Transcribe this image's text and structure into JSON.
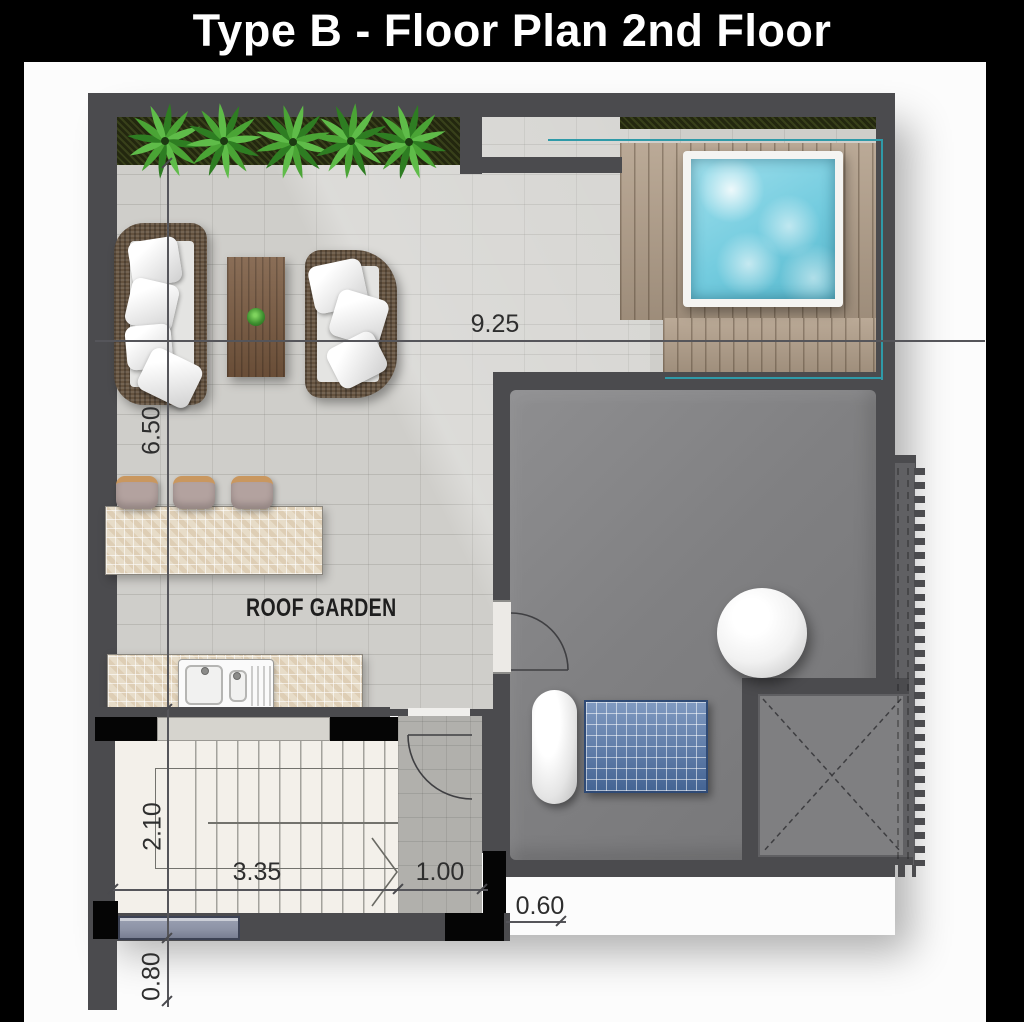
{
  "title": "Type B - Floor Plan 2nd Floor",
  "plan": {
    "room_label": "ROOF GARDEN",
    "dimensions": {
      "terrace_width_m": "9.25",
      "terrace_depth_m": "6.50",
      "stair_depth_m": "2.10",
      "stair_width_m": "3.35",
      "landing_width_m": "1.00",
      "right_offset_m": "0.60",
      "bottom_offset_m": "0.80"
    }
  },
  "colors": {
    "title_bg": "#000000",
    "title_text": "#ffffff",
    "wall": "#4b4b4e",
    "floor_tile": "#cfceca",
    "room_floor": "#808082",
    "deck": "#b3a08b",
    "pool_water": "#74ccdf",
    "glass_rail": "#2f9aa8",
    "planter_soil": "#23270f",
    "plant_green": "#3f9130",
    "counter_mosaic": "#e7dcc8",
    "stair_floor": "#f3f0ea",
    "window_glass": "#8d93a6",
    "solar_panel": "#4e72a8",
    "wicker": "#64523f",
    "wood": "#7a5a40",
    "dim_text": "#2e2e2e"
  }
}
